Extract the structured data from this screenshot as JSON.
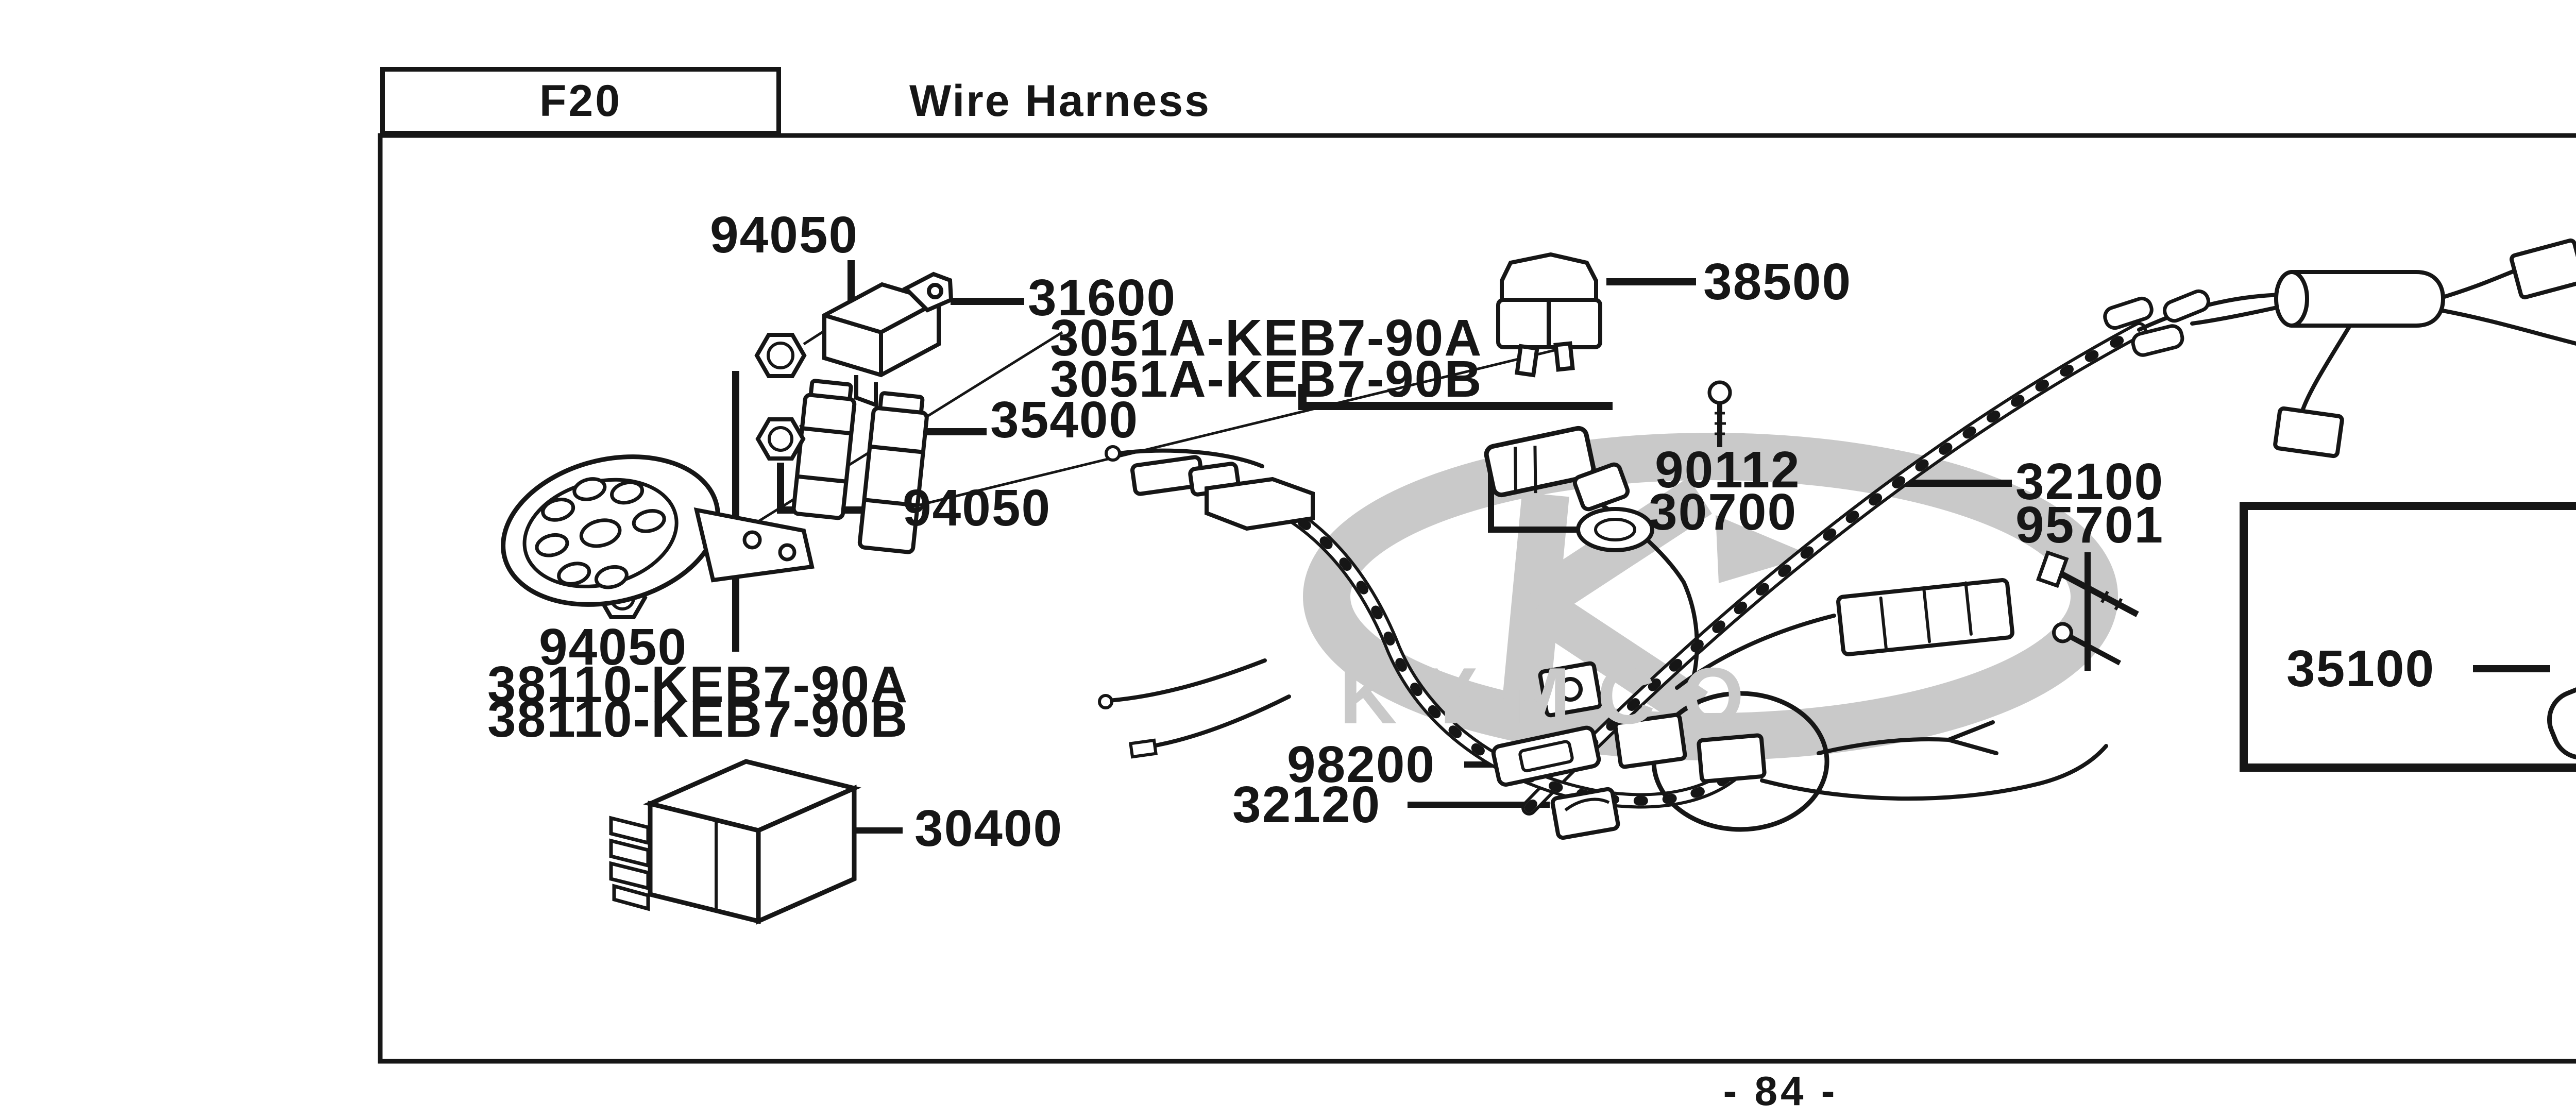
{
  "header": {
    "code": "F20",
    "title": "Wire Harness"
  },
  "page_number": "- 84 -",
  "watermark": "KYMCO",
  "colors": {
    "ink": "#161616",
    "watermark": "#c9c9c9",
    "paper": "#ffffff"
  },
  "part_labels": [
    "94050",
    "31600",
    "3051A-KEB7-90A",
    "3051A-KEB7-90B",
    "35400",
    "94050",
    "38500",
    "90112",
    "30700",
    "32100",
    "95701",
    "35010",
    "35102",
    "35100",
    "94050",
    "38110-KEB7-90A",
    "38110-KEB7-90B",
    "98200",
    "32120",
    "30400",
    "77240"
  ],
  "icons": {
    "horn": "horn-icon",
    "flasher_relay": "relay-icon",
    "fuse": "fuse-icon",
    "nut": "nut-icon",
    "ignition_coil": "coil-icon",
    "wire_harness": "harness-icon",
    "ignition_switch": "ignition-switch-icon",
    "keys": "keys-icon",
    "cdi_unit": "cdi-icon",
    "cable": "cable-icon",
    "bolt": "bolt-icon",
    "lock_set_box": "lock-set-box",
    "kymco_logo": "kymco-logo-icon"
  }
}
